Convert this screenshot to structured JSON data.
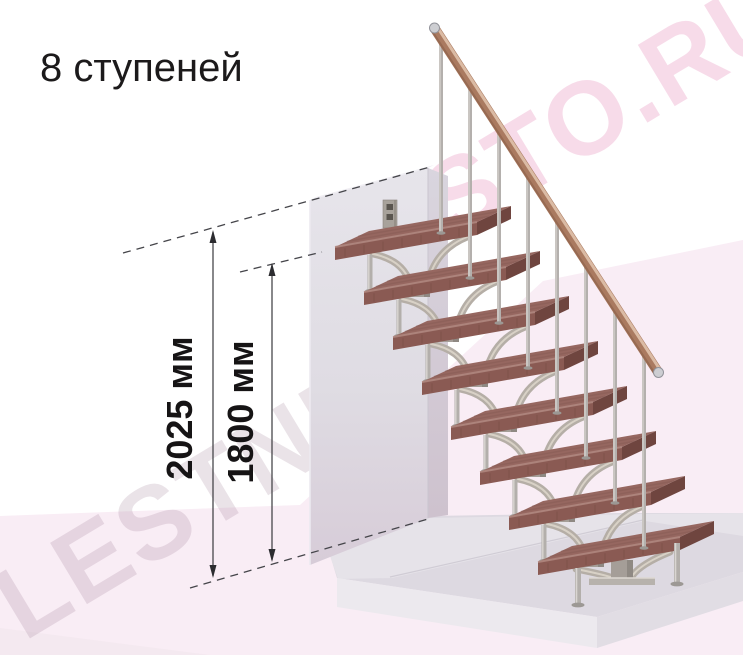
{
  "title": "8 ступеней",
  "dimensions": {
    "total_height": "2025 мм",
    "steps_height": "1800 мм"
  },
  "watermark": {
    "bottom_left": "LESTNIC",
    "top_right": "STO.RU"
  },
  "scene": {
    "steps_count": 8,
    "colors": {
      "step_top": "#966760",
      "step_front": "#8a5a53",
      "step_end": "#6f453f",
      "step_edge_highlight": "#b18880",
      "metal_branch": "#b5aea6",
      "metal_branch_light": "#d8d1c6",
      "metal_post": "#a59e98",
      "metal_post_shade": "#8f8983",
      "rod": "#b3afab",
      "rod_highlight": "#d9d5d1",
      "flange": "#9c9894",
      "rail": "#aa7a60",
      "rail_highlight": "#e0c2ac",
      "rail_shade": "#8a5f4a",
      "cap": "#cdced2",
      "wall_top": "#e6e4ea",
      "wall_bottom": "#d8cdd9",
      "wall_side": "#d6d2db",
      "ribbon_pink": "#f9edf5",
      "slab_top": "#ddd9e1",
      "slab_back": "#e6e3e9",
      "slab_front": "#ece9ee",
      "slab_right": "#e1dde4",
      "ink": "#1c1a1b"
    }
  }
}
